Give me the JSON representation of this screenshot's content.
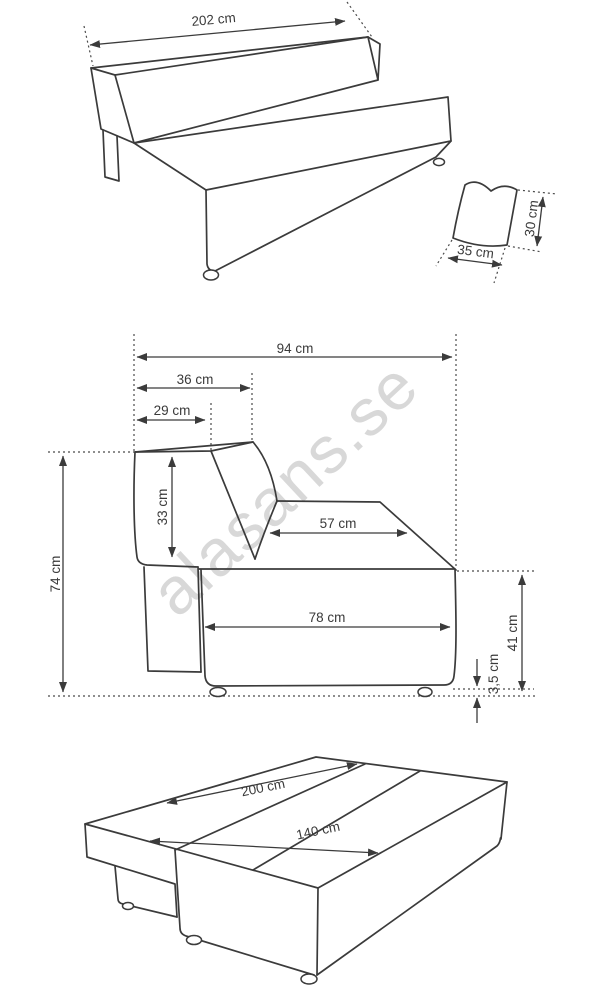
{
  "watermark": "alasans.se",
  "front_view": {
    "width": "202 cm"
  },
  "pillow": {
    "width": "35 cm",
    "height": "30 cm"
  },
  "side_view": {
    "overall_depth": "94 cm",
    "backrest_top_depth": "36 cm",
    "backrest_inner_depth": "29 cm",
    "backrest_height": "33 cm",
    "seat_top_depth": "57 cm",
    "base_depth": "78 cm",
    "overall_height": "74 cm",
    "seat_height": "41 cm",
    "foot_height": "3,5 cm"
  },
  "bed_view": {
    "length": "200 cm",
    "width": "140 cm"
  },
  "colors": {
    "line": "#3b3b3b",
    "watermark": "#d8d8d8",
    "background": "#ffffff"
  }
}
